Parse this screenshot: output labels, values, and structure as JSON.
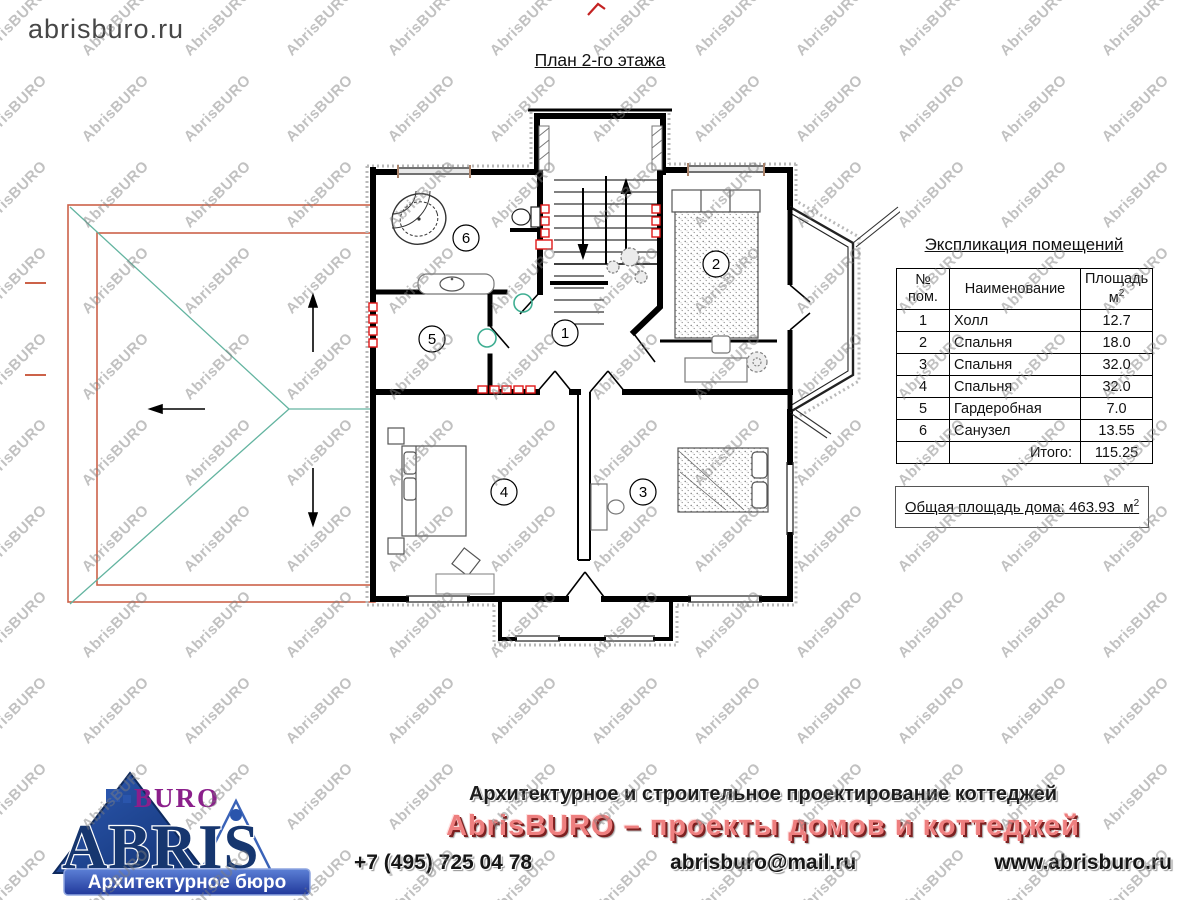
{
  "site_label": "abrisburo.ru",
  "plan": {
    "title": "План 2-го этажа",
    "room_labels": {
      "r1": "1",
      "r2": "2",
      "r3": "3",
      "r4": "4",
      "r5": "5",
      "r6": "6"
    }
  },
  "table": {
    "title": "Экспликация помещений",
    "headers": {
      "num_line1": "№",
      "num_line2": "пом.",
      "name": "Наименование",
      "area_line1": "Площадь",
      "area_unit": "м",
      "area_sup": "2"
    },
    "rows": [
      {
        "num": "1",
        "name": "Холл",
        "area": "12.7"
      },
      {
        "num": "2",
        "name": "Спальня",
        "area": "18.0"
      },
      {
        "num": "3",
        "name": "Спальня",
        "area": "32.0"
      },
      {
        "num": "4",
        "name": "Спальня",
        "area": "32.0"
      },
      {
        "num": "5",
        "name": "Гардеробная",
        "area": "7.0"
      },
      {
        "num": "6",
        "name": "Санузел",
        "area": "13.55"
      }
    ],
    "total_label": "Итого:",
    "total_value": "115.25"
  },
  "summary": {
    "label": "Общая площадь дома:",
    "value": "463.93",
    "unit": "м",
    "sup": "2"
  },
  "footer": {
    "logo_buro": "BURO",
    "logo_abris": "ABRIS",
    "logo_sub": "Архитектурное бюро",
    "tagline1": "Архитектурное и строительное проектирование коттеджей",
    "tagline2": "AbrisBURO – проекты домов и коттеджей",
    "phone": "+7 (495) 725 04 78",
    "email": "abrisburo@mail.ru",
    "website": "www.abrisburo.ru"
  },
  "watermark": {
    "text": "AbrisBURO"
  },
  "colors": {
    "roof_red": "#cc6249",
    "roof_teal": "#63b4a0",
    "radiator_red": "#e01818",
    "door_green": "#3fae92",
    "brand_red": "#ee7f7f",
    "brand_blue": "#1c3f8f",
    "buro_purple": "#8b1f8b"
  }
}
